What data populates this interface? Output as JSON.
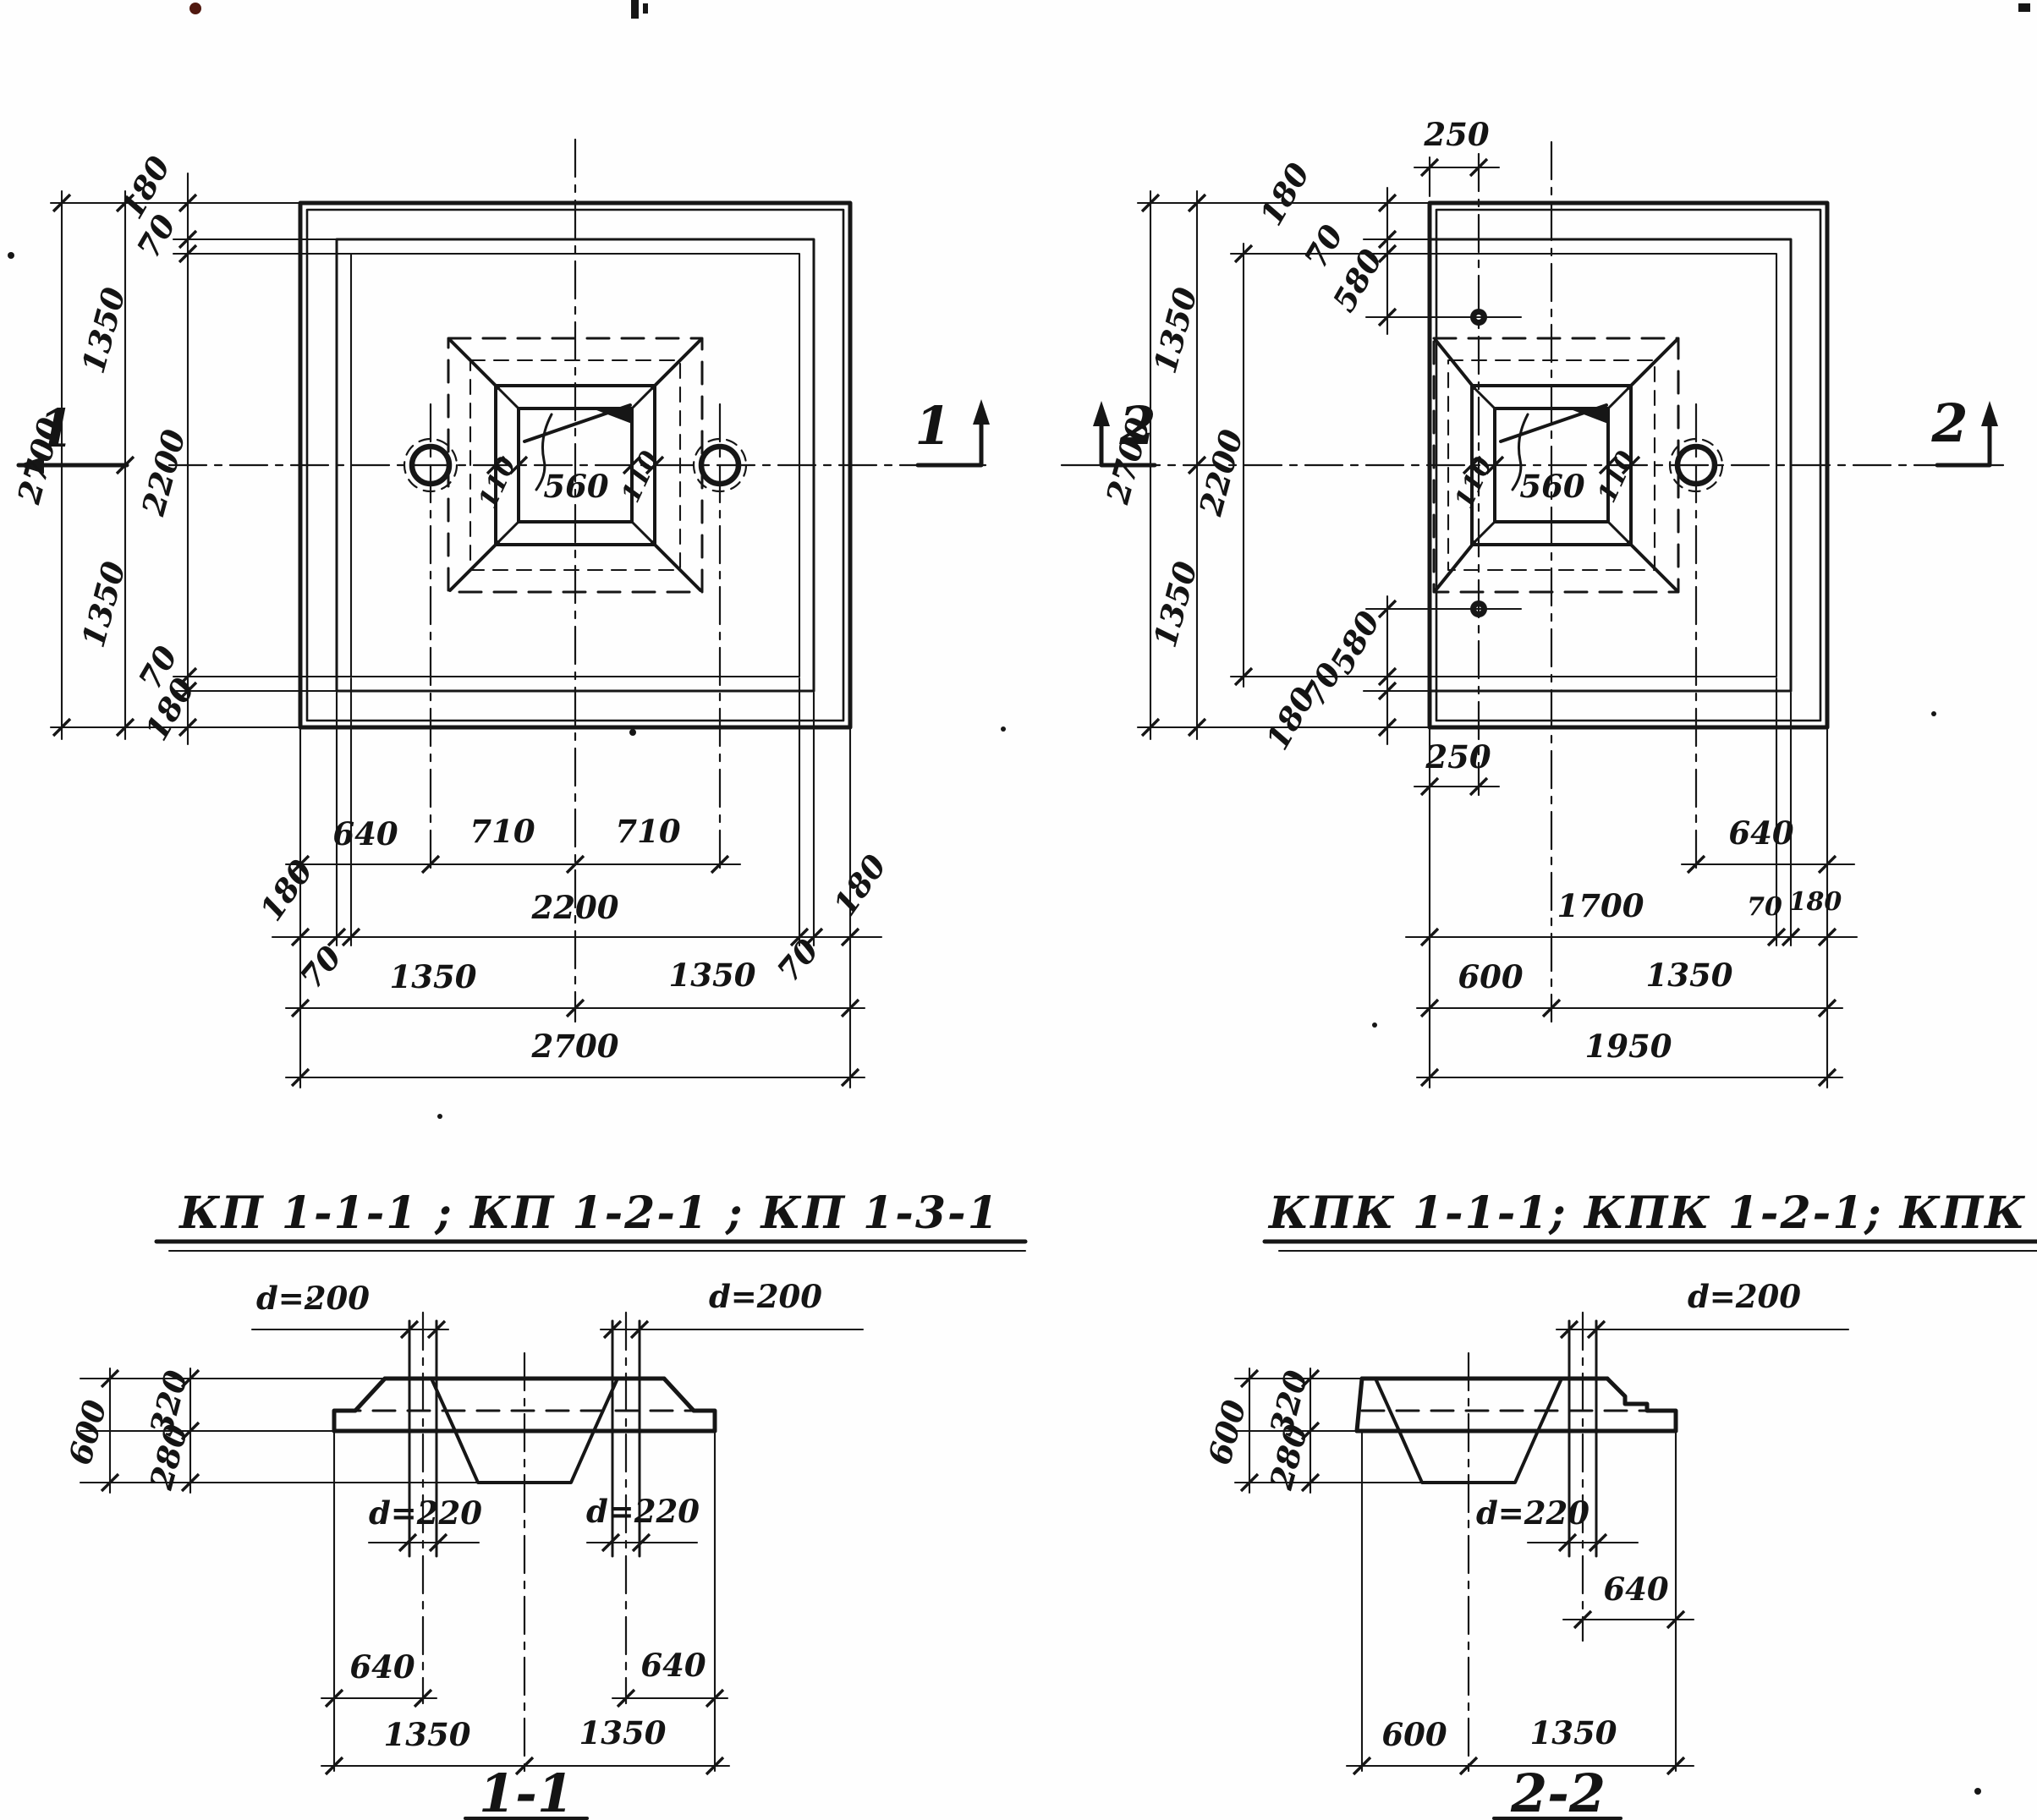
{
  "plan_kp": {
    "title": "КП 1-1-1 ; КП 1-2-1 ; КП 1-3-1",
    "mark": "1",
    "chain": {
      "e180t": "180",
      "e70t": "70",
      "mid": "2200",
      "e70b": "70",
      "e180b": "180",
      "half_t": "1350",
      "half_b": "1350",
      "outer": "2700"
    },
    "socket": {
      "l": "110",
      "c": "560",
      "r": "110"
    },
    "rows": {
      "r1": [
        "640",
        "710",
        "710"
      ],
      "r2": [
        "180",
        "2200",
        "180"
      ],
      "r2s": [
        "70",
        "70"
      ],
      "r3": [
        "1350",
        "1350"
      ],
      "r4": "2700"
    }
  },
  "plan_kpk": {
    "title": "КПК 1-1-1; КПК 1-2-1; КПК 1-3-1",
    "mark": "2",
    "top250": "250",
    "bot250": "250",
    "edge_top": [
      "180",
      "70",
      "580"
    ],
    "edge_bottom": [
      "580",
      "70",
      "180"
    ],
    "chain": {
      "mid": "2200",
      "half_t": "1350",
      "half_b": "1350",
      "outer": "2700"
    },
    "socket": {
      "l": "110",
      "c": "560",
      "r": "110"
    },
    "rows": {
      "r1": "640",
      "r2": [
        "1700",
        "70",
        "180"
      ],
      "r3": [
        "600",
        "1350"
      ],
      "r4": "1950"
    }
  },
  "section_11": {
    "title": "1-1",
    "d200_left": "d=200",
    "d200_right": "d=200",
    "d220_left": "d=220",
    "d220_right": "d=220",
    "h600": "600",
    "h320": "320",
    "h280": "280",
    "off_left": "640",
    "off_right": "640",
    "half_left": "1350",
    "half_right": "1350"
  },
  "section_22": {
    "title": "2-2",
    "d200": "d=200",
    "d220": "d=220",
    "h600": "600",
    "h320": "320",
    "h280": "280",
    "off": "640",
    "w600": "600",
    "w1350": "1350"
  }
}
